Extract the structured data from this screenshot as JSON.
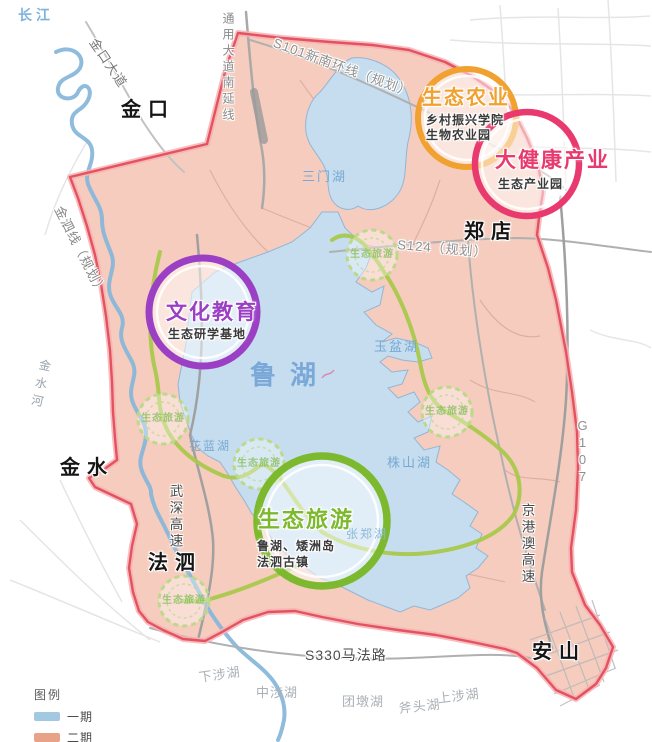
{
  "water": {
    "yangtze": "长江",
    "main_lake": "鲁湖",
    "river": "金水河",
    "lakes": [
      "三门湖",
      "玉盆湖",
      "花蓝湖",
      "株山湖",
      "张郑湖",
      "下涉湖",
      "中涉湖",
      "团墩湖",
      "斧头湖",
      "上涉湖"
    ]
  },
  "towns": [
    "金口",
    "郑店",
    "金水",
    "法泗",
    "安山"
  ],
  "roads": {
    "jinkou_avenue": "金口大道",
    "tongyong_south_ext": "通用大道南延线",
    "s101": "S101新南环线（规划）",
    "jinsi_line": "金泗线（规划）",
    "s124": "S124（规划）",
    "g107": "G107",
    "jinggangao_expwy": "京港澳高速",
    "wushen_expwy": "武深高速",
    "s330": "S330马法路"
  },
  "zones": [
    {
      "title": "生态农业",
      "lines": [
        "乡村振兴学院",
        "生物农业园"
      ],
      "color": "#F0A12F"
    },
    {
      "title": "大健康产业",
      "lines": [
        "生态产业园"
      ],
      "color": "#E83A6F"
    },
    {
      "title": "文化教育",
      "lines": [
        "生态研学基地"
      ],
      "color": "#9B3FC4"
    },
    {
      "title": "生态旅游",
      "lines": [
        "鲁湖、矮洲岛",
        "法泗古镇"
      ],
      "color": "#7DB92E"
    }
  ],
  "eco_marker": {
    "label": "生态旅游"
  },
  "legend": {
    "title": "图例",
    "items": [
      {
        "label": "一期",
        "color": "#A3C8E2"
      },
      {
        "label": "二期",
        "color": "#E8A287"
      }
    ]
  },
  "map_colors": {
    "boundary": "#E4525E",
    "phase1_fill": "#C5DDEE",
    "phase2_fill": "#F4C8B7",
    "scenic_route": "#A9C84C"
  }
}
